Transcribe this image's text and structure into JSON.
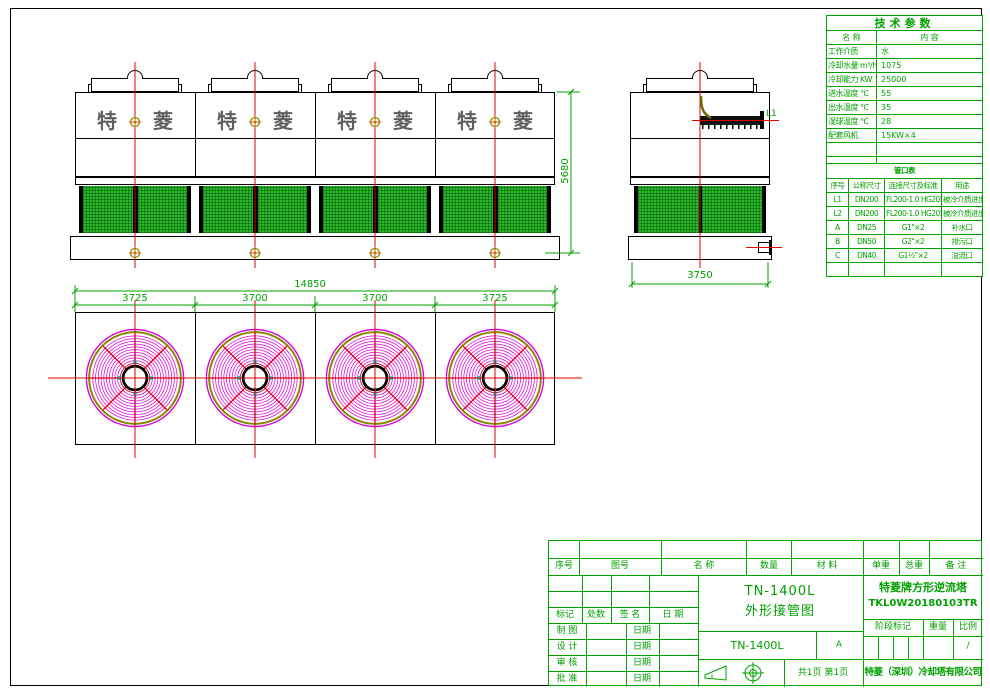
{
  "drawing": {
    "front_view": {
      "brand_char1": "特",
      "brand_char2": "菱",
      "dim_height": "5680"
    },
    "side_view": {
      "pipe_label": "L1",
      "dim_width": "3750"
    },
    "plan_view": {
      "dim_total": "14850",
      "dim_segments": [
        "3725",
        "3700",
        "3700",
        "3725"
      ]
    }
  },
  "tech_table": {
    "title": "技术参数",
    "col_headers": [
      "名  称",
      "内  容"
    ],
    "rows": [
      [
        "工作介质",
        "水"
      ],
      [
        "冷却水量 m³/h",
        "1075"
      ],
      [
        "冷却能力 KW",
        "25000"
      ],
      [
        "进水温度 ℃",
        "55"
      ],
      [
        "出水温度 ℃",
        "35"
      ],
      [
        "湿球温度 ℃",
        "28"
      ],
      [
        "配套风机",
        "15KW×4"
      ],
      [
        "",
        ""
      ],
      [
        "",
        ""
      ]
    ]
  },
  "pipe_table": {
    "title": "管口表",
    "col_headers": [
      "序号",
      "公称尺寸",
      "连接尺寸及标准",
      "用途"
    ],
    "rows": [
      [
        "L1",
        "DN200",
        "FL200-1.0 HG20593",
        "被冷介质进出口"
      ],
      [
        "L2",
        "DN200",
        "FL200-1.0 HG20593",
        "被冷介质进出口"
      ],
      [
        "A",
        "DN25",
        "G1\"×2",
        "补水口"
      ],
      [
        "B",
        "DN50",
        "G2\"×2",
        "排污口"
      ],
      [
        "C",
        "DN40",
        "G1½\"×2",
        "溢流口"
      ],
      [
        "",
        "",
        "",
        ""
      ]
    ]
  },
  "title_block": {
    "parts_header": [
      "序号",
      "图号",
      "名 称",
      "数量",
      "材 料",
      "单重",
      "总重",
      "备 注"
    ],
    "rev_header": [
      "标记",
      "处数",
      "签 名",
      "日 期"
    ],
    "sign_rows": [
      {
        "label": "制 图"
      },
      {
        "label": "设 计"
      },
      {
        "label": "审 核"
      },
      {
        "label": "批 准"
      }
    ],
    "date_label": "日期",
    "drawing_title_line1": "TN-1400L",
    "drawing_title_line2": "外形接管图",
    "model": "TN-1400L",
    "revision": "A",
    "page_info": "共1页 第1页",
    "product_name": "特菱牌方形逆流塔",
    "drawing_no": "TKL0W20180103TR",
    "stage_header": [
      "阶段标记",
      "重量",
      "比例"
    ],
    "scale_value": "/",
    "company": "特菱（深圳）冷却塔有限公司"
  }
}
